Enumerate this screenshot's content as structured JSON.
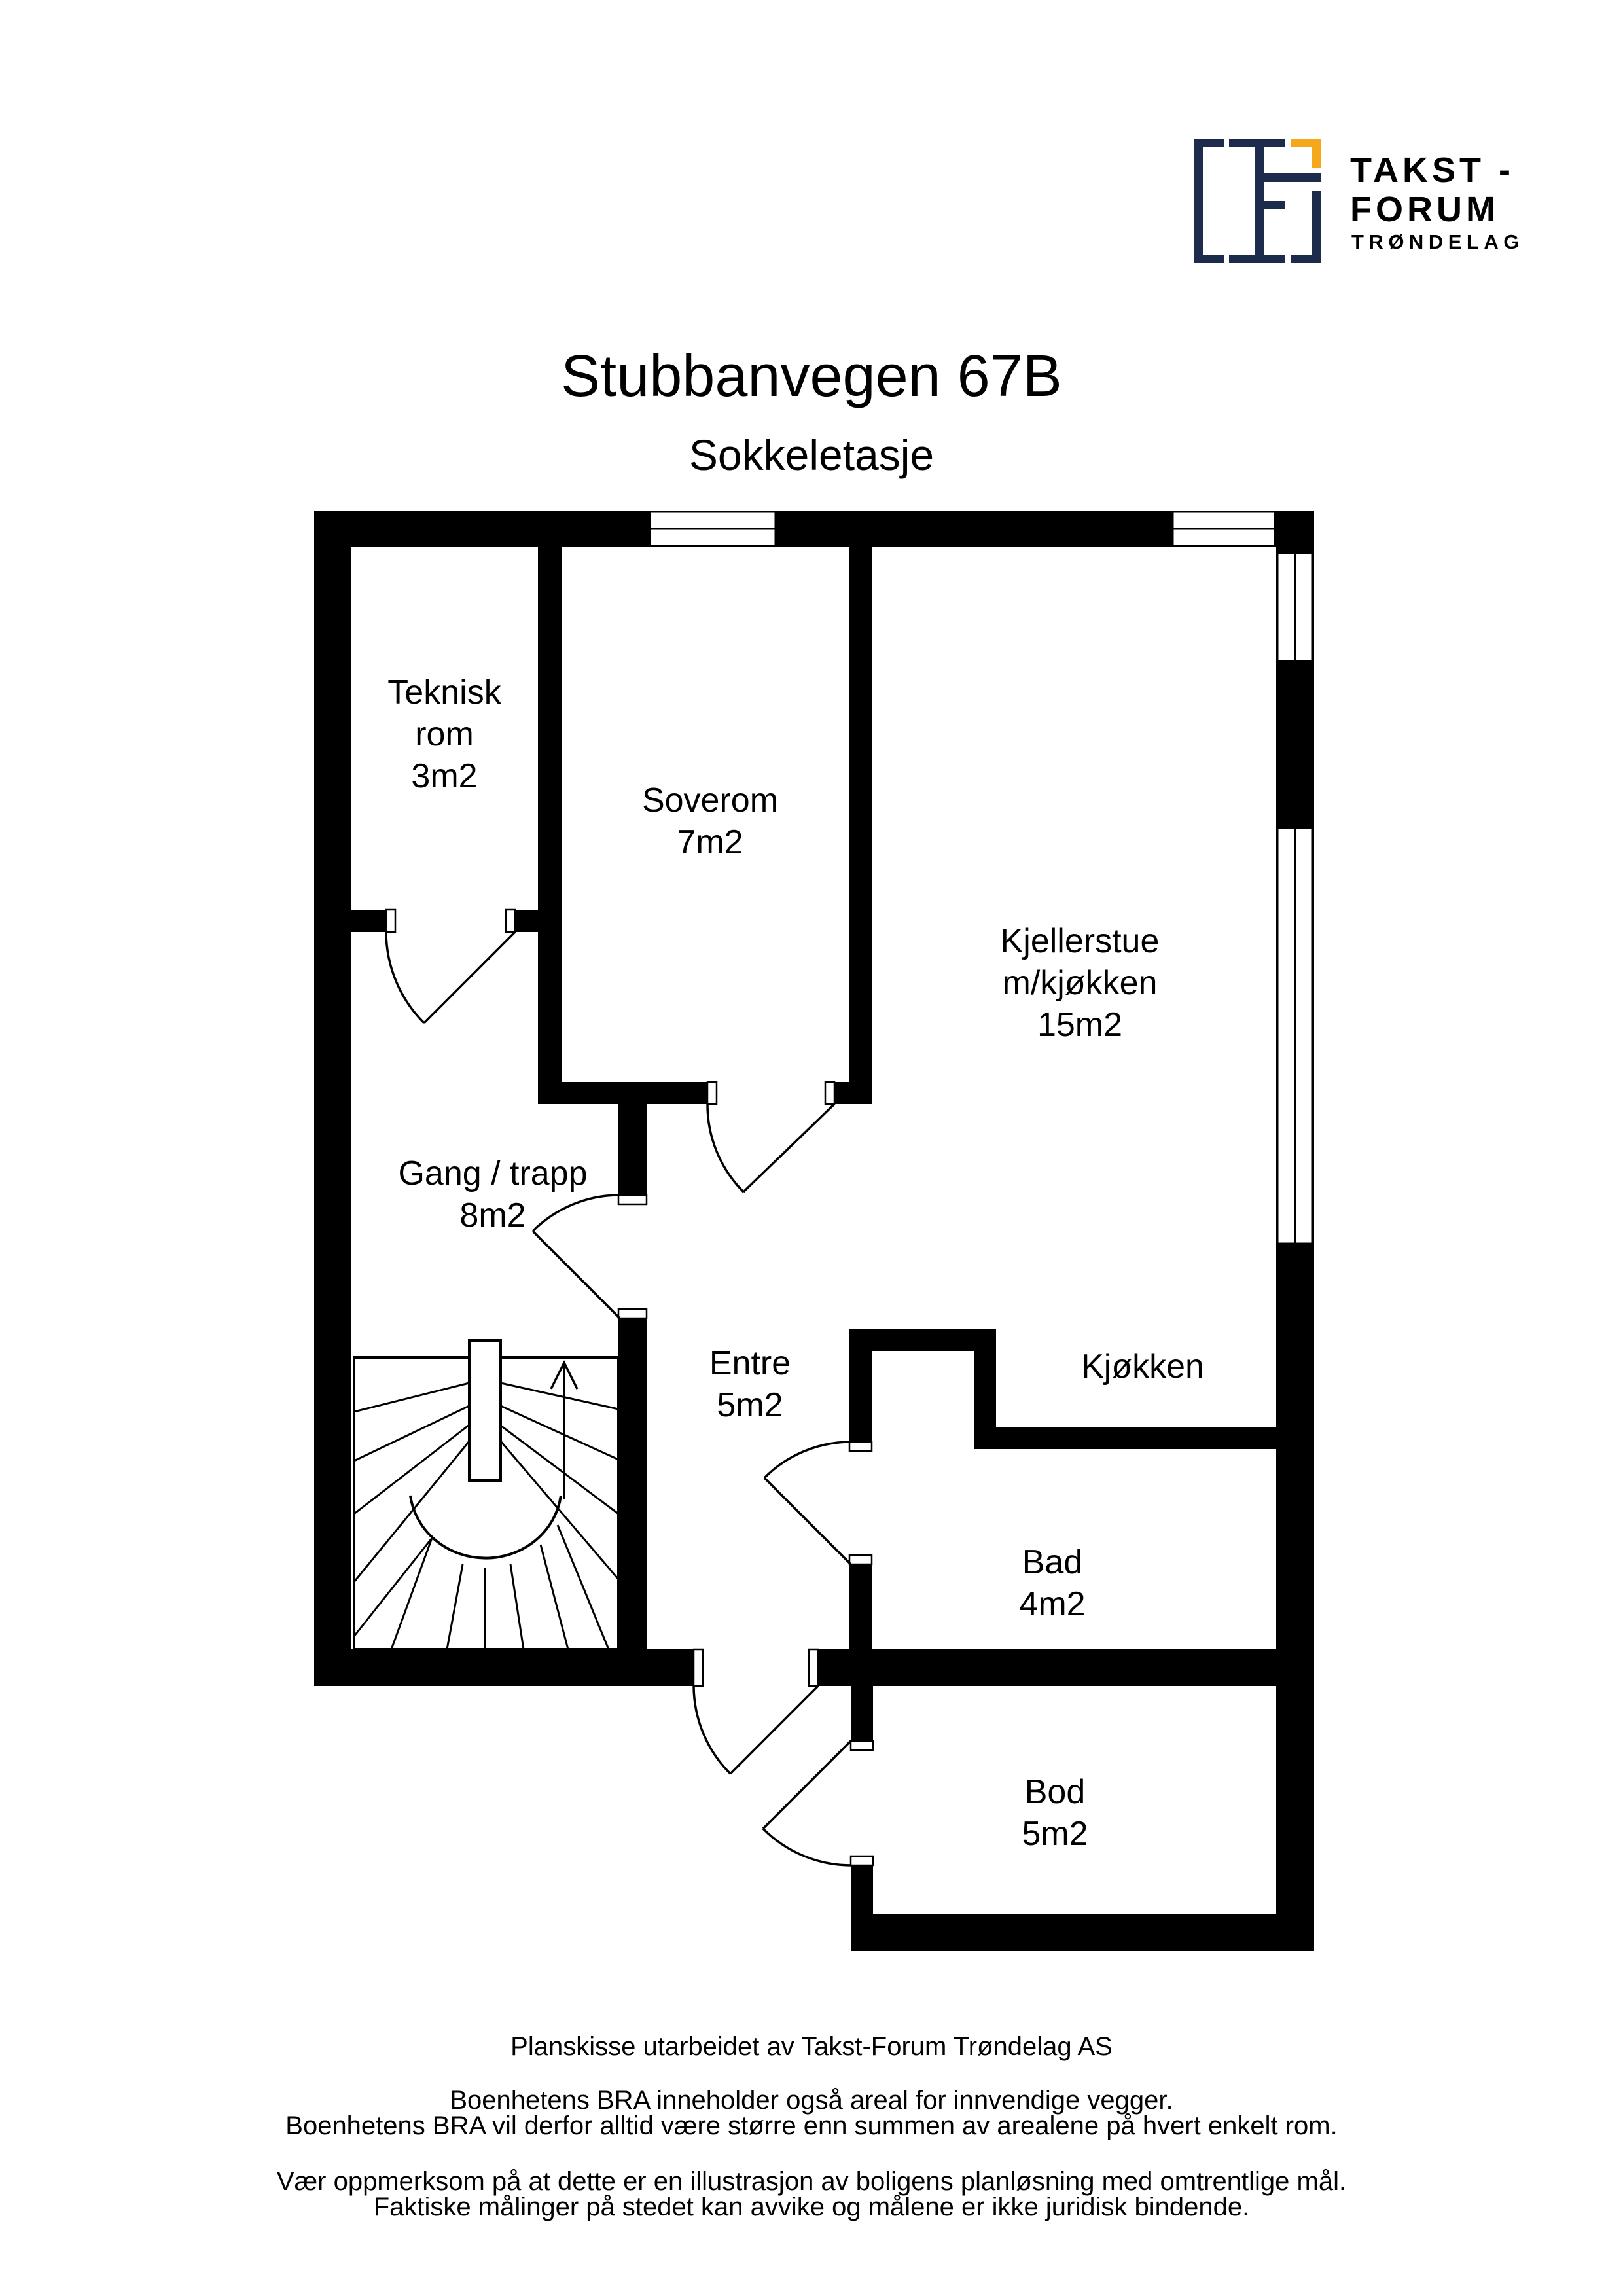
{
  "page": {
    "title": "Stubbanvegen 67B",
    "subtitle": "Sokkeletasje"
  },
  "logo": {
    "line1": "TAKST -",
    "line2": "FORUM",
    "line3": "TRØNDELAG",
    "navy": "#1d2b4d",
    "orange": "#f5a81c"
  },
  "floorplan": {
    "ink": "#000000",
    "rooms": [
      {
        "id": "teknisk",
        "lines": [
          "Teknisk",
          "rom",
          "3m2"
        ]
      },
      {
        "id": "soverom",
        "lines": [
          "Soverom",
          "7m2"
        ]
      },
      {
        "id": "kjellerstue",
        "lines": [
          "Kjellerstue",
          "m/kjøkken",
          "15m2"
        ]
      },
      {
        "id": "gang",
        "lines": [
          "Gang / trapp",
          "8m2"
        ]
      },
      {
        "id": "entre",
        "lines": [
          "Entre",
          "5m2"
        ]
      },
      {
        "id": "kjokken",
        "lines": [
          "Kjøkken"
        ]
      },
      {
        "id": "bad",
        "lines": [
          "Bad",
          "4m2"
        ]
      },
      {
        "id": "bod",
        "lines": [
          "Bod",
          "5m2"
        ]
      }
    ]
  },
  "footer": {
    "lines": [
      "Planskisse utarbeidet av Takst-Forum Trøndelag AS",
      "Boenhetens BRA inneholder også areal for innvendige vegger.",
      "Boenhetens BRA vil derfor alltid være større enn summen av arealene på hvert enkelt rom.",
      "Vær oppmerksom på at dette er en illustrasjon av boligens planløsning med omtrentlige mål.",
      "Faktiske målinger på stedet kan avvike og målene er ikke juridisk bindende."
    ]
  }
}
